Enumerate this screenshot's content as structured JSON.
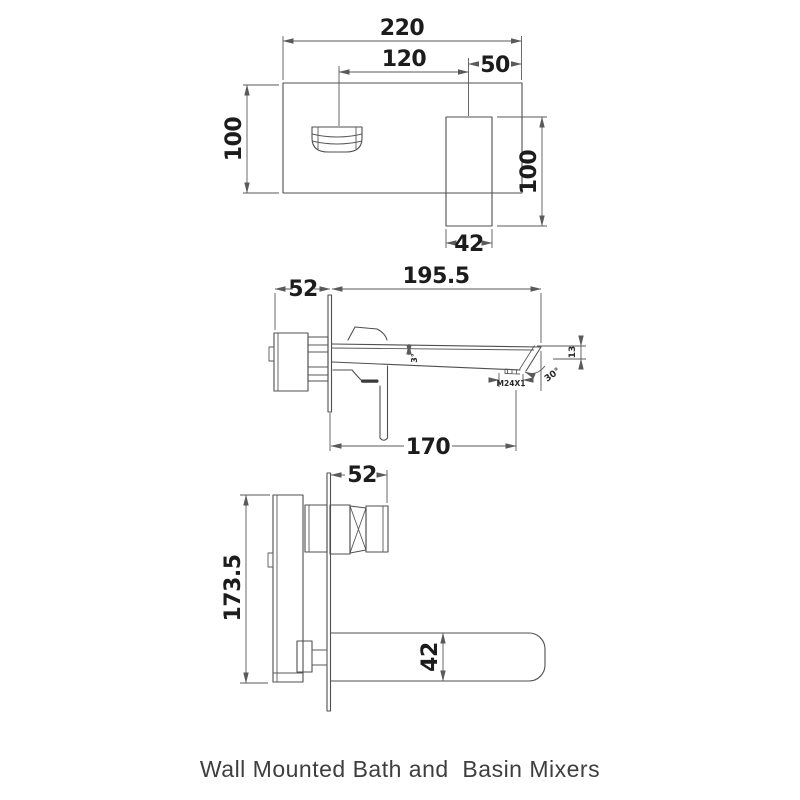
{
  "caption": "Wall Mounted Bath and  Basin Mixers",
  "colors": {
    "line": "#4f4f4f",
    "dimension": "#5a5a5a",
    "text": "#1c1c1c",
    "background": "#ffffff"
  },
  "front_view": {
    "dim_plate_width": "220",
    "dim_handle_to_spout": "120",
    "dim_spout_to_edge": "50",
    "dim_plate_height": "100",
    "dim_spout_drop": "100",
    "dim_spout_width": "42"
  },
  "basin_side_view": {
    "dim_wall_depth": "52",
    "dim_spout_reach": "195.5",
    "dim_outlet_reach": "170",
    "dim_taper_angle": "3°",
    "dim_aerator_thread": "M24X1",
    "dim_tip_angle": "30°",
    "dim_tip_height": "13"
  },
  "bath_side_view": {
    "dim_wall_depth": "52",
    "dim_body_height": "173.5",
    "dim_spout_height": "42"
  }
}
